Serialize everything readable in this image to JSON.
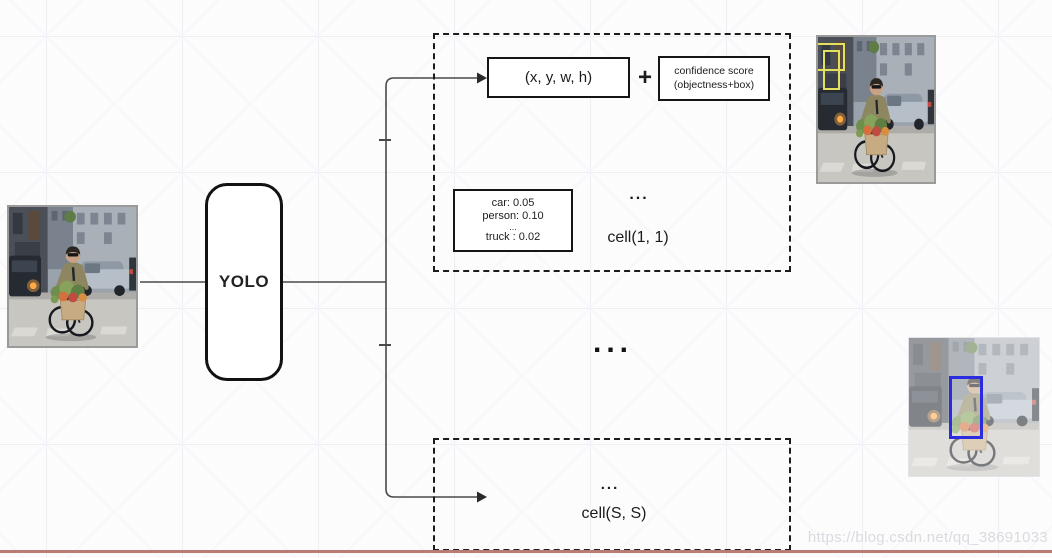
{
  "diagram": {
    "yolo": {
      "label": "YOLO"
    },
    "cell_1_1": {
      "bbox_label": "(x, y, w, h)",
      "plus": "+",
      "confidence_score": [
        "confidence score",
        "(objectness+box)"
      ],
      "class_scores": [
        "car: 0.05",
        "person: 0.10",
        "...",
        "truck : 0.02"
      ],
      "dots": "...",
      "label": "cell(1, 1)"
    },
    "ellipsis_between_cells": "...",
    "cell_S_S": {
      "dots": "...",
      "label": "cell(S, S)"
    }
  },
  "images": {
    "input_photo": "cyclist-with-flowers-street-photo",
    "grid_cells_photo": "street-photo-with-yellow-grid-cells",
    "detection_photo": "street-photo-with-blue-detection-box"
  },
  "watermark": {
    "text": "https://blog.csdn.net/qq_38691033"
  },
  "colors": {
    "cell_highlight_yellow": "#e3e05e",
    "detection_box_blue": "#2b2bdf",
    "footer_rule_red": "#b97c72"
  }
}
